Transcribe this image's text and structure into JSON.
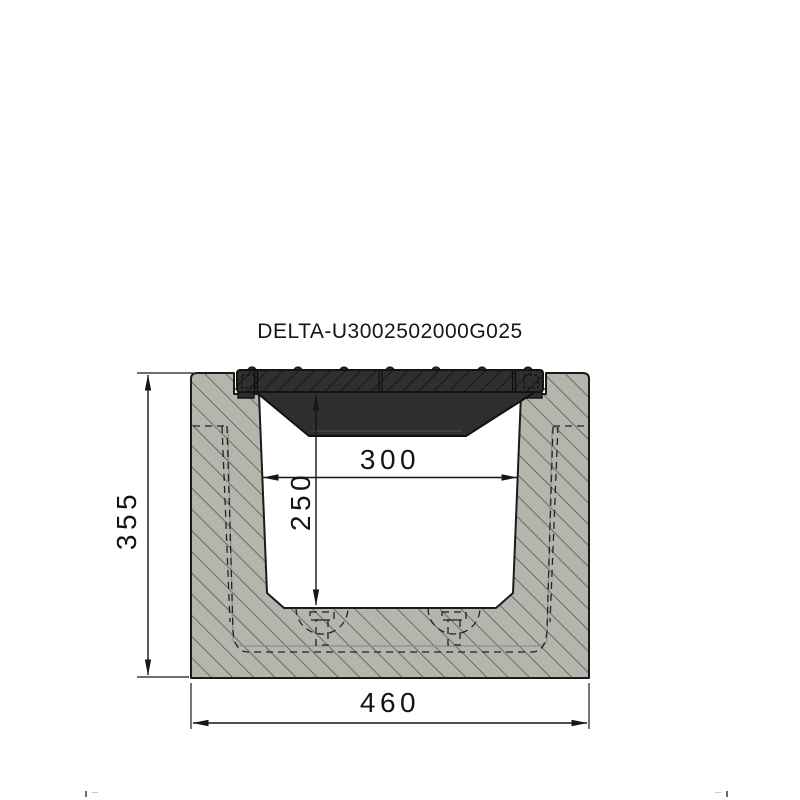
{
  "title": "DELTA-U3002502000G025",
  "dimensions": {
    "total_height": {
      "label": "355"
    },
    "inner_depth": {
      "label": "250"
    },
    "inner_width": {
      "label": "300"
    },
    "total_width": {
      "label": "460"
    }
  },
  "colors": {
    "background": "#ffffff",
    "concrete_fill": "#b5b5ad",
    "concrete_hatch": "#4c4c44",
    "grating_fill": "#2e2e2e",
    "grating_hatch": "#0d0d0d",
    "line": "#1a1a1a"
  }
}
